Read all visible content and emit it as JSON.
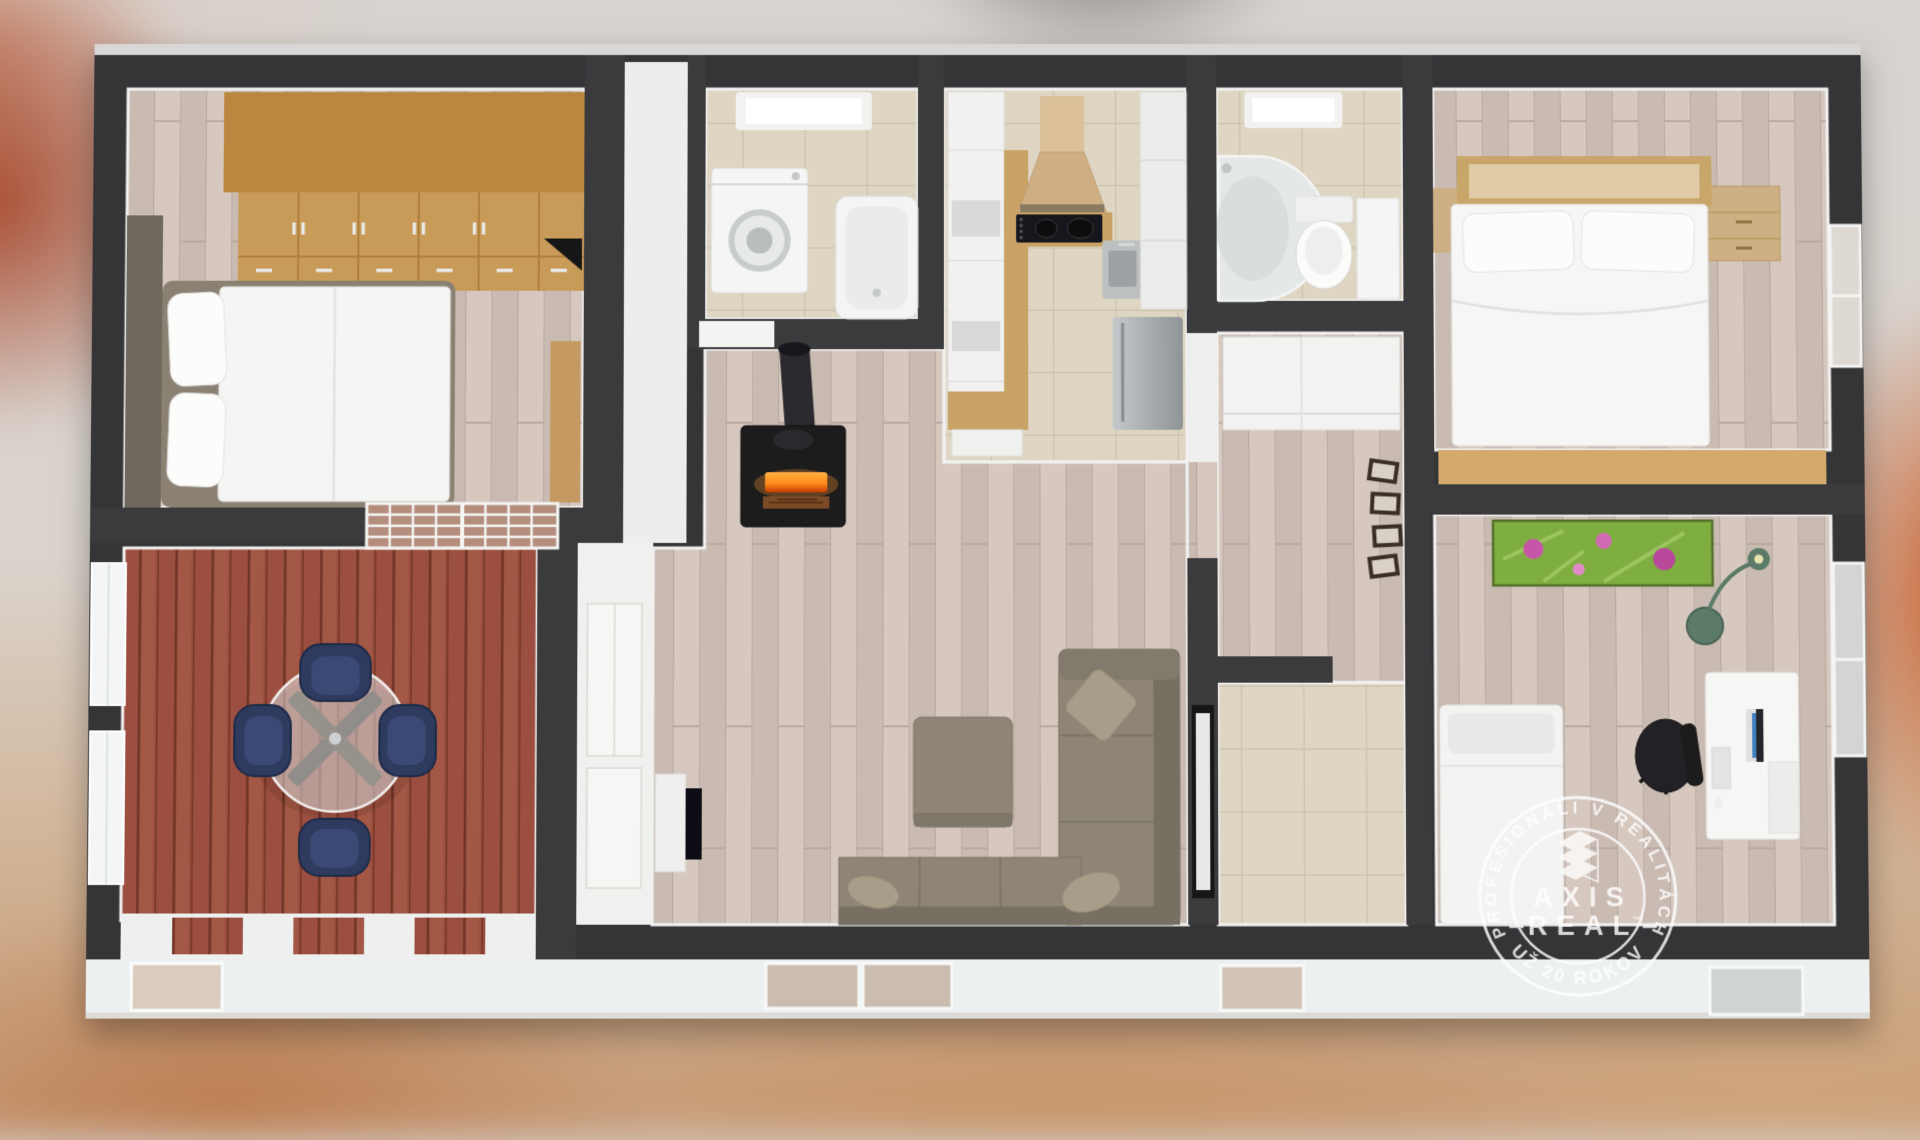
{
  "watermark": {
    "arc_text_top": "PROFESIONÁLI V REALITÁCH",
    "arc_text_bottom": "UŽ 20 ROKOV",
    "brand_line1": "AXIS",
    "brand_line2": "REAL",
    "trademark": "™",
    "logo_icon": "axis-real-building-logo",
    "color": "#ffffff"
  },
  "scene": {
    "type": "3d-floor-plan-render",
    "view": "top-down cutaway of single-storey home over blurred interior photo background",
    "rooms": [
      {
        "name": "bedroom-1",
        "furniture": [
          "wardrobe-row",
          "double-bed",
          "pillows",
          "headboard-panel",
          "bench"
        ]
      },
      {
        "name": "terrace",
        "furniture": [
          "round-glass-table",
          "navy-armchair-top",
          "navy-armchair-bottom",
          "navy-armchair-left",
          "navy-armchair-right",
          "french-doors",
          "wall-windows",
          "railing"
        ]
      },
      {
        "name": "laundry-bathroom",
        "furniture": [
          "skylight",
          "washing-machine",
          "bathtub"
        ]
      },
      {
        "name": "kitchen",
        "furniture": [
          "tall-cabinets",
          "range-hood",
          "cooktop",
          "wood-counter",
          "sink",
          "fridge",
          "upper-cabinets"
        ]
      },
      {
        "name": "shower-bathroom",
        "furniture": [
          "skylight",
          "corner-shower",
          "toilet",
          "door"
        ]
      },
      {
        "name": "bedroom-2",
        "furniture": [
          "double-bed",
          "headboard",
          "nightstand-left",
          "nightstand-right",
          "bench",
          "window"
        ]
      },
      {
        "name": "hallway",
        "furniture": [
          "white-cabinet",
          "picture-frames"
        ]
      },
      {
        "name": "living-room",
        "furniture": [
          "wood-stove",
          "chimney-pipe",
          "tv",
          "corner-sofa",
          "ottoman",
          "cushions",
          "partition-picture"
        ]
      },
      {
        "name": "storage-room",
        "furniture": []
      },
      {
        "name": "office",
        "furniture": [
          "flower-painting",
          "floor-lamp",
          "desk",
          "monitor",
          "office-chair",
          "daybed",
          "window"
        ]
      }
    ]
  },
  "colors": {
    "wall_dark": "#3a3a3c",
    "wall_face": "#f2f2f2",
    "laminate_floor": "#cfc1b8",
    "terrace_deck": "#9c5040",
    "tile_floor": "#ded5c2",
    "wardrobe_wood": "#c99b58",
    "bench_wood": "#d3a96c",
    "sofa_taupe": "#8e8577",
    "navy_chair": "#2d3a5e",
    "stove_black": "#1d1d1f",
    "fire_orange": "#ff8c1a",
    "facade_white": "#edf0f0",
    "painting_green": "#7fae3f",
    "painting_pink": "#c857a8",
    "watermark_white": "#ffffff"
  }
}
